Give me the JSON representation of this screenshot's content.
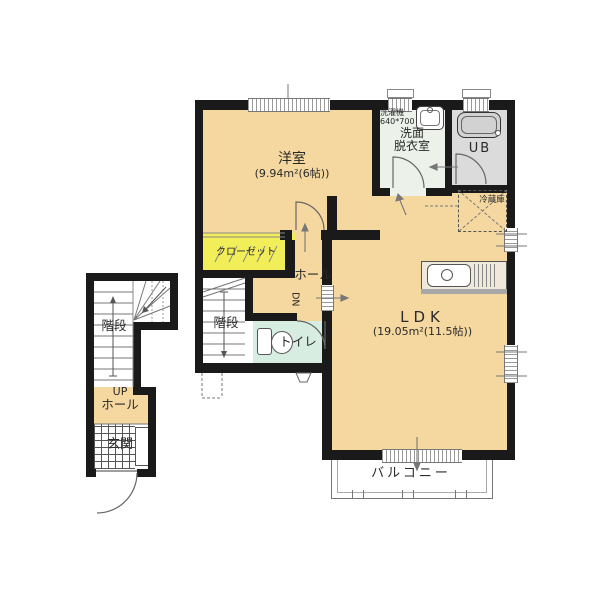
{
  "plan_type": "floor-plan-2F",
  "colors": {
    "wall": "#1a1a1a",
    "room_peach": "#F5D8A0",
    "closet_yellow": "#F1EE5A",
    "toilet_green": "#D8EDE2",
    "washroom_green": "#ECF2EA",
    "unit_bath_gray": "#DBDBDB"
  },
  "rooms": {
    "western_room": {
      "label": "洋室",
      "area": "(9.94m²(6帖))"
    },
    "ldk": {
      "label": "LDK",
      "area": "(19.05m²(11.5帖))"
    },
    "washroom": {
      "line1": "洗面",
      "line2": "脱衣室"
    },
    "unit_bath": {
      "label": "UB"
    },
    "closet": {
      "label": "クローゼット"
    },
    "hall": {
      "label": "ホール",
      "dn": "DN"
    },
    "stairs_center": {
      "label": "階段"
    },
    "stairs_left": {
      "label": "階段"
    },
    "toilet": {
      "label": "トイレ"
    },
    "up_hall": {
      "line1": "UP",
      "line2": "ホール"
    },
    "entrance": {
      "label": "玄関"
    },
    "balcony": {
      "label": "バルコニー"
    }
  },
  "fixtures": {
    "washing_machine": {
      "line1": "洗濯機",
      "line2": "640*700"
    },
    "refrigerator": {
      "label": "冷蔵庫"
    }
  }
}
